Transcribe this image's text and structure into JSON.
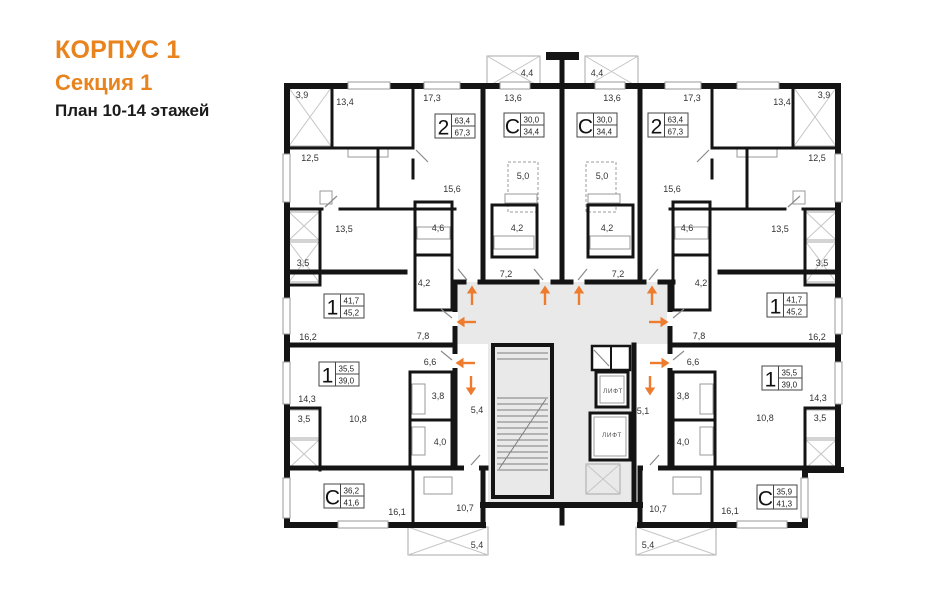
{
  "header": {
    "building": "КОРПУС 1",
    "section": "Секция 1",
    "plan_title": "План 10-14 этажей"
  },
  "colors": {
    "accent": "#e8831d",
    "wall": "#141414",
    "corridor": "#e9e9e9",
    "arrow": "#ed7c2f"
  },
  "plan": {
    "lift_label": "ЛИФТ",
    "lifts": [
      {
        "x": 613,
        "y": 393
      },
      {
        "x": 612,
        "y": 437
      }
    ],
    "apartments": [
      {
        "glyph": "2",
        "area_living": "63,4",
        "area_total": "67,3",
        "x": 435,
        "y": 114
      },
      {
        "glyph": "С",
        "area_living": "30,0",
        "area_total": "34,4",
        "x": 504,
        "y": 113
      },
      {
        "glyph": "С",
        "area_living": "30,0",
        "area_total": "34,4",
        "x": 577,
        "y": 113
      },
      {
        "glyph": "2",
        "area_living": "63,4",
        "area_total": "67,3",
        "x": 648,
        "y": 113
      },
      {
        "glyph": "1",
        "area_living": "41,7",
        "area_total": "45,2",
        "x": 324,
        "y": 294
      },
      {
        "glyph": "1",
        "area_living": "41,7",
        "area_total": "45,2",
        "x": 767,
        "y": 293
      },
      {
        "glyph": "1",
        "area_living": "35,5",
        "area_total": "39,0",
        "x": 319,
        "y": 362
      },
      {
        "glyph": "1",
        "area_living": "35,5",
        "area_total": "39,0",
        "x": 762,
        "y": 366
      },
      {
        "glyph": "С",
        "area_living": "36,2",
        "area_total": "41,6",
        "x": 324,
        "y": 484
      },
      {
        "glyph": "С",
        "area_living": "35,9",
        "area_total": "41,3",
        "x": 757,
        "y": 485
      }
    ],
    "dimensions": [
      {
        "x": 302,
        "y": 98,
        "t": "3,9"
      },
      {
        "x": 824,
        "y": 98,
        "t": "3,9"
      },
      {
        "x": 345,
        "y": 105,
        "t": "13,4"
      },
      {
        "x": 782,
        "y": 105,
        "t": "13,4"
      },
      {
        "x": 432,
        "y": 101,
        "t": "17,3"
      },
      {
        "x": 692,
        "y": 101,
        "t": "17,3"
      },
      {
        "x": 513,
        "y": 101,
        "t": "13,6"
      },
      {
        "x": 612,
        "y": 101,
        "t": "13,6"
      },
      {
        "x": 527,
        "y": 76,
        "t": "4,4"
      },
      {
        "x": 597,
        "y": 76,
        "t": "4,4"
      },
      {
        "x": 310,
        "y": 161,
        "t": "12,5"
      },
      {
        "x": 817,
        "y": 161,
        "t": "12,5"
      },
      {
        "x": 452,
        "y": 192,
        "t": "15,6"
      },
      {
        "x": 672,
        "y": 192,
        "t": "15,6"
      },
      {
        "x": 523,
        "y": 179,
        "t": "5,0"
      },
      {
        "x": 602,
        "y": 179,
        "t": "5,0"
      },
      {
        "x": 344,
        "y": 232,
        "t": "13,5"
      },
      {
        "x": 780,
        "y": 232,
        "t": "13,5"
      },
      {
        "x": 438,
        "y": 231,
        "t": "4,6"
      },
      {
        "x": 687,
        "y": 231,
        "t": "4,6"
      },
      {
        "x": 517,
        "y": 231,
        "t": "4,2"
      },
      {
        "x": 607,
        "y": 231,
        "t": "4,2"
      },
      {
        "x": 506,
        "y": 277,
        "t": "7,2"
      },
      {
        "x": 618,
        "y": 277,
        "t": "7,2"
      },
      {
        "x": 303,
        "y": 266,
        "t": "3,5"
      },
      {
        "x": 822,
        "y": 266,
        "t": "3,5"
      },
      {
        "x": 424,
        "y": 286,
        "t": "4,2"
      },
      {
        "x": 701,
        "y": 286,
        "t": "4,2"
      },
      {
        "x": 308,
        "y": 340,
        "t": "16,2"
      },
      {
        "x": 817,
        "y": 340,
        "t": "16,2"
      },
      {
        "x": 423,
        "y": 339,
        "t": "7,8"
      },
      {
        "x": 699,
        "y": 339,
        "t": "7,8"
      },
      {
        "x": 430,
        "y": 365,
        "t": "6,6"
      },
      {
        "x": 693,
        "y": 365,
        "t": "6,6"
      },
      {
        "x": 438,
        "y": 399,
        "t": "3,8"
      },
      {
        "x": 683,
        "y": 399,
        "t": "3,8"
      },
      {
        "x": 307,
        "y": 402,
        "t": "14,3"
      },
      {
        "x": 818,
        "y": 401,
        "t": "14,3"
      },
      {
        "x": 477,
        "y": 413,
        "t": "5,4"
      },
      {
        "x": 643,
        "y": 414,
        "t": "5,1"
      },
      {
        "x": 304,
        "y": 422,
        "t": "3,5"
      },
      {
        "x": 820,
        "y": 421,
        "t": "3,5"
      },
      {
        "x": 358,
        "y": 422,
        "t": "10,8"
      },
      {
        "x": 765,
        "y": 421,
        "t": "10,8"
      },
      {
        "x": 440,
        "y": 445,
        "t": "4,0"
      },
      {
        "x": 683,
        "y": 445,
        "t": "4,0"
      },
      {
        "x": 465,
        "y": 511,
        "t": "10,7"
      },
      {
        "x": 658,
        "y": 512,
        "t": "10,7"
      },
      {
        "x": 397,
        "y": 515,
        "t": "16,1"
      },
      {
        "x": 730,
        "y": 514,
        "t": "16,1"
      },
      {
        "x": 477,
        "y": 548,
        "t": "5,4"
      },
      {
        "x": 648,
        "y": 548,
        "t": "5,4"
      }
    ],
    "arrows": [
      {
        "x": 472,
        "y": 296,
        "dir": "up"
      },
      {
        "x": 545,
        "y": 296,
        "dir": "up"
      },
      {
        "x": 579,
        "y": 296,
        "dir": "up"
      },
      {
        "x": 652,
        "y": 296,
        "dir": "up"
      },
      {
        "x": 467,
        "y": 322,
        "dir": "left"
      },
      {
        "x": 466,
        "y": 363,
        "dir": "left"
      },
      {
        "x": 658,
        "y": 322,
        "dir": "right"
      },
      {
        "x": 659,
        "y": 363,
        "dir": "right"
      },
      {
        "x": 471,
        "y": 385,
        "dir": "down"
      },
      {
        "x": 650,
        "y": 385,
        "dir": "down"
      }
    ]
  }
}
